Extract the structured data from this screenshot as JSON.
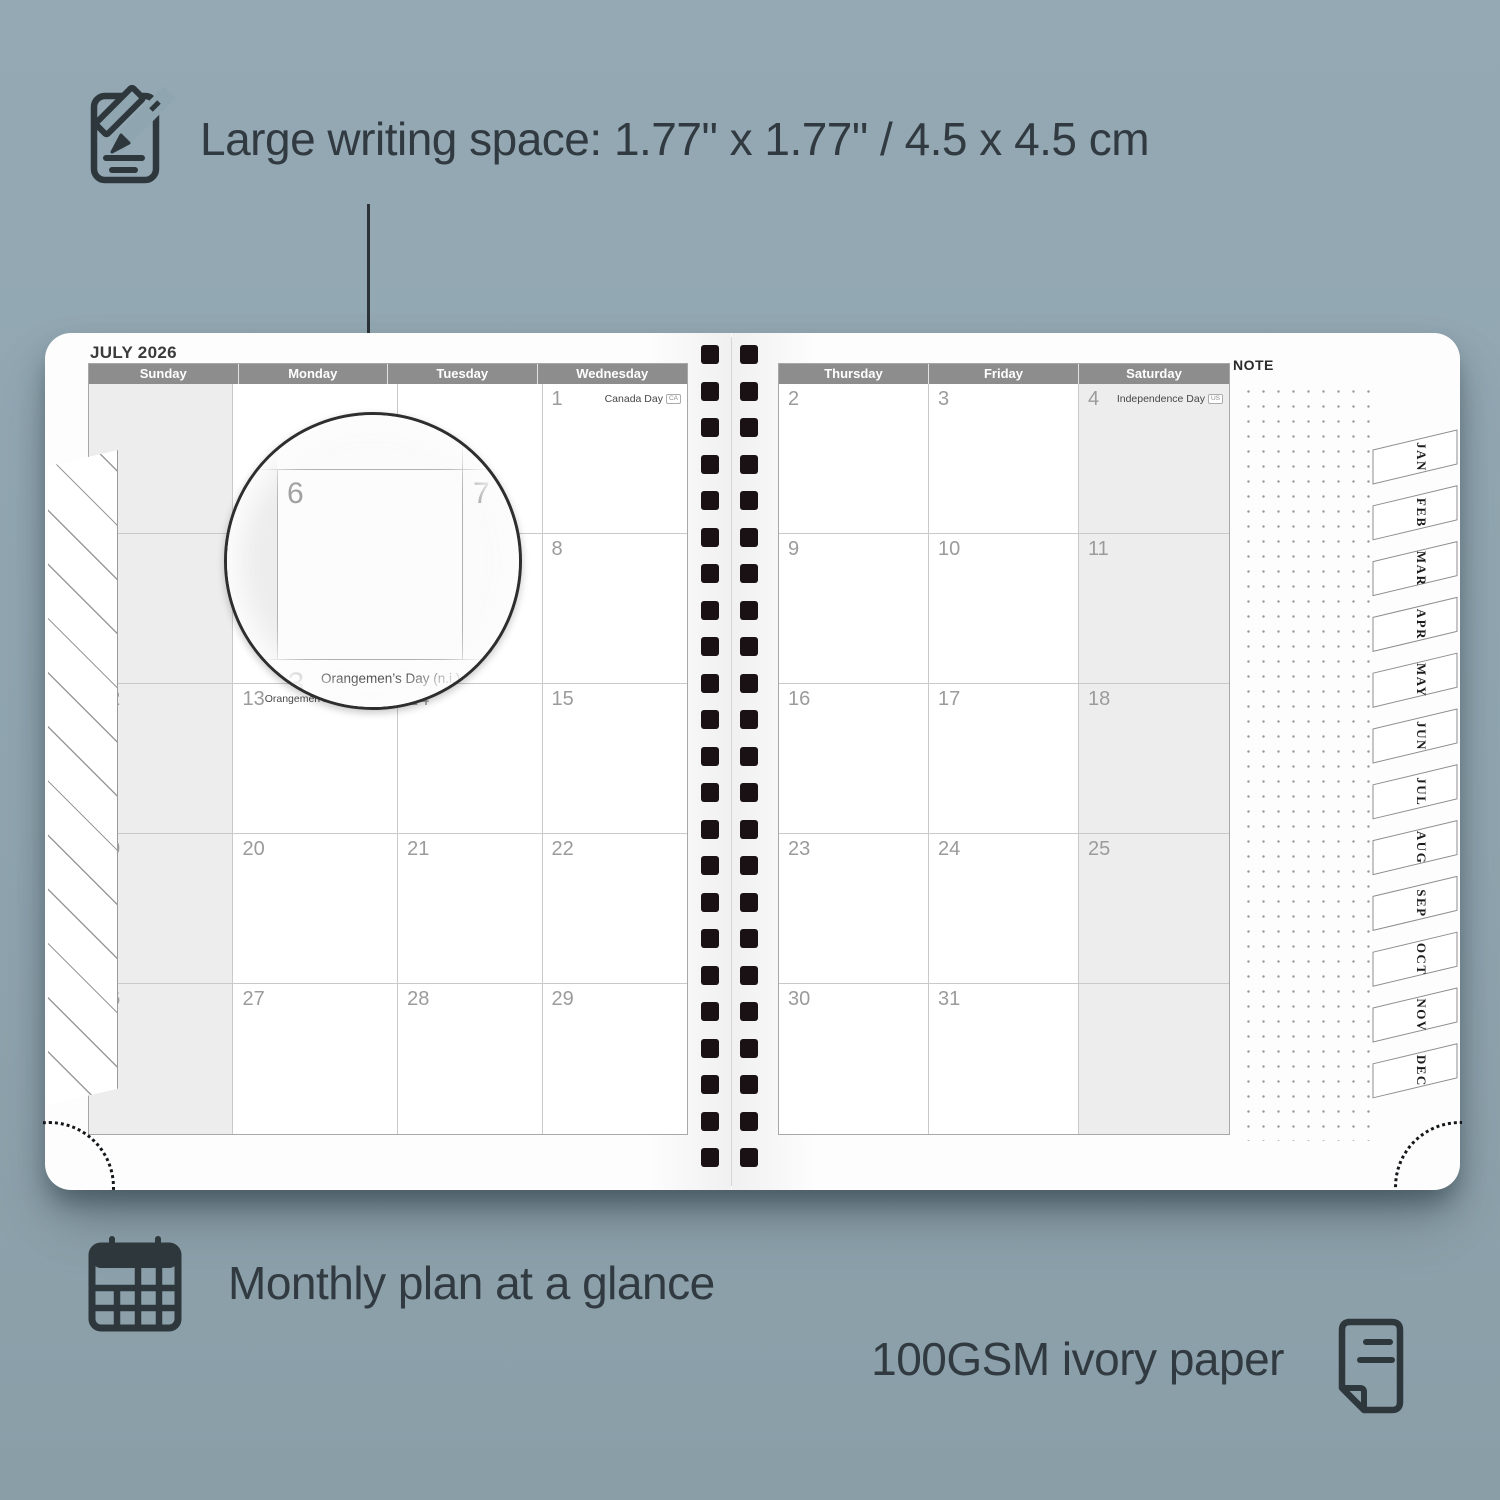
{
  "colors": {
    "background": "#90a5b0",
    "ink": "#313a40",
    "header_bar": "#8d8d8d",
    "shaded_cell": "#ededed",
    "binding_hole": "#1a1115"
  },
  "annotations": {
    "writing_space": {
      "text": "Large writing space: 1.77\" x 1.77\" / 4.5 x 4.5 cm"
    },
    "monthly_plan": {
      "text": "Monthly plan at a glance"
    },
    "paper": {
      "text": "100GSM ivory paper"
    }
  },
  "planner": {
    "month_title": "JULY 2026",
    "note_label": "NOTE",
    "left_day_headers": [
      "Sunday",
      "Monday",
      "Tuesday",
      "Wednesday"
    ],
    "right_day_headers": [
      "Thursday",
      "Friday",
      "Saturday"
    ],
    "left_weeks": [
      [
        {
          "shaded": true
        },
        {},
        {},
        {
          "day": "1",
          "holiday": "Canada Day",
          "badge": "CA"
        }
      ],
      [
        {
          "day": "5",
          "shaded": true
        },
        {
          "day": "6"
        },
        {
          "day": "7"
        },
        {
          "day": "8"
        }
      ],
      [
        {
          "day": "12",
          "shaded": true
        },
        {
          "day": "13",
          "holiday": "Orangemen’s Day (n.i.)",
          "badge": "UK"
        },
        {
          "day": "14"
        },
        {
          "day": "15"
        }
      ],
      [
        {
          "day": "19",
          "shaded": true
        },
        {
          "day": "20"
        },
        {
          "day": "21"
        },
        {
          "day": "22"
        }
      ],
      [
        {
          "day": "26",
          "shaded": true
        },
        {
          "day": "27"
        },
        {
          "day": "28"
        },
        {
          "day": "29"
        }
      ]
    ],
    "right_weeks": [
      [
        {
          "day": "2"
        },
        {
          "day": "3"
        },
        {
          "day": "4",
          "holiday": "Independence Day",
          "badge": "US",
          "shaded": true
        }
      ],
      [
        {
          "day": "9"
        },
        {
          "day": "10"
        },
        {
          "day": "11",
          "shaded": true
        }
      ],
      [
        {
          "day": "16"
        },
        {
          "day": "17"
        },
        {
          "day": "18",
          "shaded": true
        }
      ],
      [
        {
          "day": "23"
        },
        {
          "day": "24"
        },
        {
          "day": "25",
          "shaded": true
        }
      ],
      [
        {
          "day": "30"
        },
        {
          "day": "31"
        },
        {
          "shaded": true
        }
      ]
    ],
    "month_tabs": [
      "JAN",
      "FEB",
      "MAR",
      "APR",
      "MAY",
      "JUN",
      "JUL",
      "AUG",
      "SEP",
      "OCT",
      "NOV",
      "DEC"
    ]
  },
  "magnifier": {
    "left_day": "6",
    "right_day": "7",
    "bottom_day": "13",
    "bottom_holiday": "Orangemen’s Day (n.i.)",
    "bottom_badge": "UK"
  }
}
